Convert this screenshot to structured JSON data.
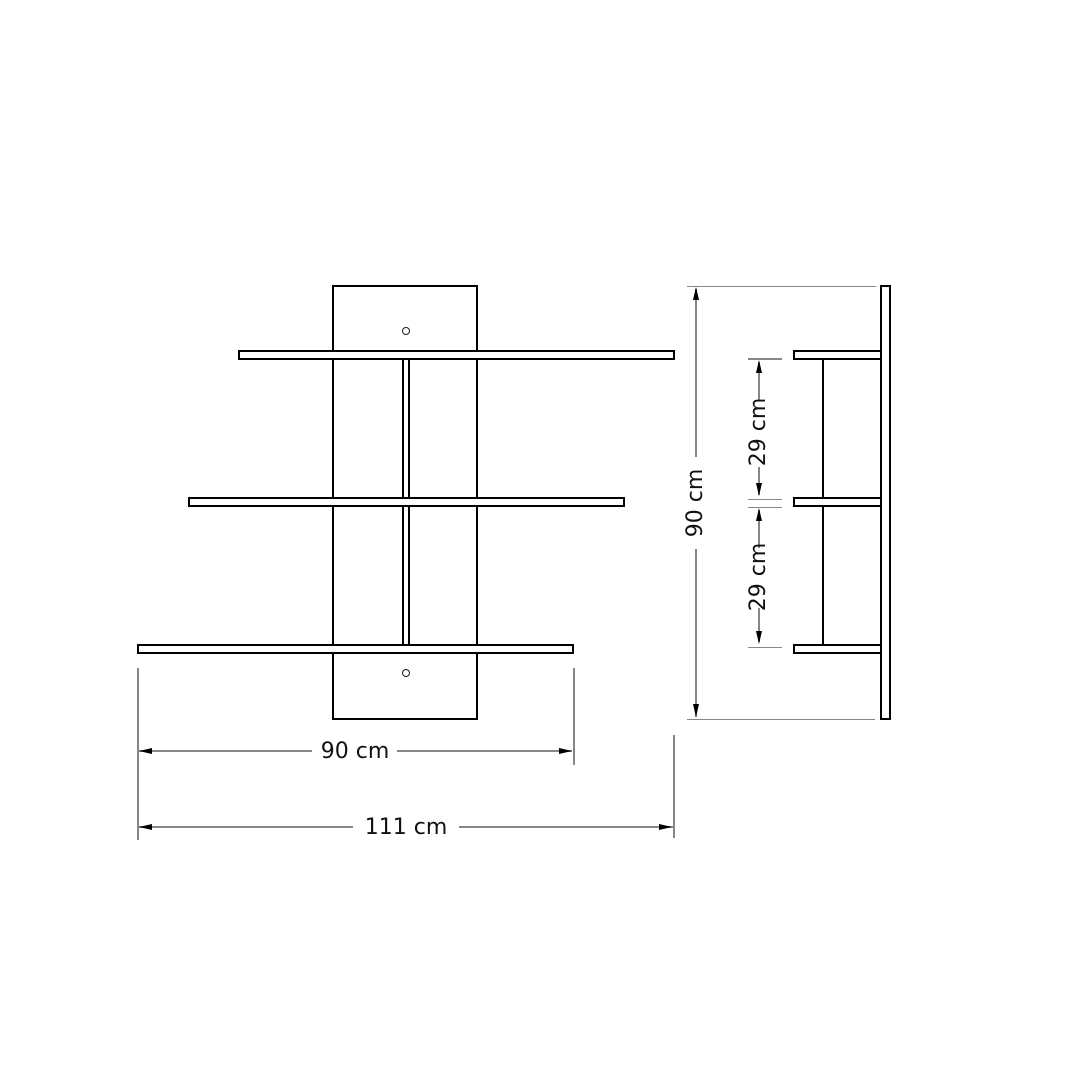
{
  "drawing": {
    "dimensions": {
      "shelf_width": "90 cm",
      "total_width": "111 cm",
      "total_height": "90 cm",
      "upper_gap": "29 cm",
      "lower_gap": "29 cm"
    },
    "colors": {
      "background": "#ffffff",
      "outline": "#000000",
      "dim_line": "#868686",
      "dim_text": "#111111"
    }
  }
}
